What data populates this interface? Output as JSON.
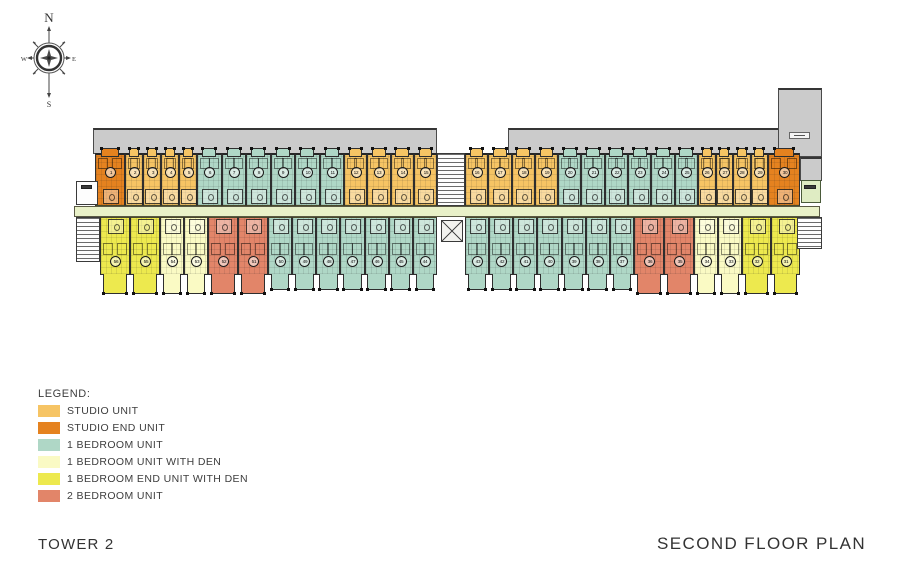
{
  "titles": {
    "tower": "TOWER 2",
    "plan": "SECOND FLOOR PLAN"
  },
  "compass": {
    "north": "N",
    "east": "E",
    "south": "S",
    "west": "W"
  },
  "legend": {
    "title": "LEGEND:",
    "items": [
      {
        "label": "STUDIO UNIT",
        "type": "studio"
      },
      {
        "label": "STUDIO END UNIT",
        "type": "studioEnd"
      },
      {
        "label": "1 BEDROOM UNIT",
        "type": "oneBed"
      },
      {
        "label": "1 BEDROOM UNIT WITH DEN",
        "type": "oneBedDen"
      },
      {
        "label": "1 BEDROOM END UNIT WITH DEN",
        "type": "oneBedEndDen"
      },
      {
        "label": "2 BEDROOM UNIT",
        "type": "twoBed"
      }
    ]
  },
  "colors": {
    "studio": "#F6C464",
    "studioEnd": "#E5821F",
    "oneBed": "#AFD7C6",
    "oneBedDen": "#FAFAC4",
    "oneBedEndDen": "#EDE94E",
    "twoBed": "#E28569",
    "corridor": "#E9F1C8",
    "roof": "#CBCBCB"
  },
  "plan": {
    "roof_areas": [
      {
        "name": "roof-band-left",
        "x": 93,
        "y": 128,
        "w": 344,
        "h": 26
      },
      {
        "name": "roof-band-right",
        "x": 508,
        "y": 128,
        "w": 272,
        "h": 26
      },
      {
        "name": "roof-column-right",
        "x": 778,
        "y": 88,
        "w": 44,
        "h": 69
      },
      {
        "name": "roof-stub-right",
        "x": 800,
        "y": 157,
        "w": 22,
        "h": 24
      }
    ],
    "corridor": {
      "name": "central-corridor",
      "x": 74,
      "y": 206,
      "w": 746,
      "h": 11
    },
    "cores": [
      {
        "kind": "room",
        "name": "left-entry-room",
        "x": 76,
        "y": 181,
        "w": 22,
        "h": 24
      },
      {
        "kind": "chip-dark",
        "name": "left-room-label",
        "x": 81,
        "y": 185,
        "w": 11,
        "h": 4
      },
      {
        "kind": "stair",
        "name": "left-stair",
        "x": 76,
        "y": 217,
        "w": 24,
        "h": 45
      },
      {
        "kind": "stair",
        "name": "center-stair",
        "x": 437,
        "y": 153,
        "w": 28,
        "h": 53
      },
      {
        "kind": "elev",
        "name": "center-elevator",
        "x": 441,
        "y": 220,
        "w": 22,
        "h": 22
      },
      {
        "kind": "room-green",
        "name": "right-utility-room",
        "x": 801,
        "y": 180,
        "w": 20,
        "h": 23
      },
      {
        "kind": "chip-dark",
        "name": "right-room-label",
        "x": 804,
        "y": 185,
        "w": 12,
        "h": 4
      },
      {
        "kind": "stair",
        "name": "right-stair",
        "x": 797,
        "y": 217,
        "w": 25,
        "h": 32
      },
      {
        "kind": "chip-light",
        "name": "roof-column-label",
        "x": 789,
        "y": 132,
        "w": 21,
        "h": 7
      }
    ],
    "top_row": {
      "y": 153,
      "h": 53,
      "segments": [
        {
          "type": "studioEnd",
          "x": 95,
          "w": 30,
          "units": [
            1
          ]
        },
        {
          "type": "studio",
          "x": 125,
          "w": 72,
          "units": [
            2,
            3,
            4,
            5
          ]
        },
        {
          "type": "oneBed",
          "x": 197,
          "w": 147,
          "units": [
            6,
            7,
            8,
            9,
            10,
            11
          ]
        },
        {
          "type": "studio",
          "x": 344,
          "w": 93,
          "units": [
            12,
            13,
            14,
            15
          ]
        },
        {
          "type": "studio",
          "x": 465,
          "w": 93,
          "units": [
            16,
            17,
            18,
            19
          ]
        },
        {
          "type": "oneBed",
          "x": 558,
          "w": 140,
          "units": [
            20,
            21,
            22,
            23,
            24,
            25
          ]
        },
        {
          "type": "studio",
          "x": 698,
          "w": 70,
          "units": [
            26,
            27,
            28,
            29
          ]
        },
        {
          "type": "studioEnd",
          "x": 768,
          "w": 32,
          "units": [
            30
          ]
        }
      ]
    },
    "bottom_row": {
      "y": 217,
      "h": 58,
      "segments": [
        {
          "type": "oneBedEndDen",
          "x": 100,
          "w": 60,
          "units": [
            56,
            55
          ]
        },
        {
          "type": "oneBedDen",
          "x": 160,
          "w": 48,
          "units": [
            54,
            53
          ]
        },
        {
          "type": "twoBed",
          "x": 208,
          "w": 60,
          "units": [
            52,
            51
          ]
        },
        {
          "type": "oneBed",
          "x": 268,
          "w": 169,
          "units": [
            50,
            49,
            48,
            47,
            46,
            45,
            44
          ]
        },
        {
          "type": "oneBed",
          "x": 465,
          "w": 169,
          "units": [
            43,
            42,
            41,
            40,
            39,
            38,
            37
          ]
        },
        {
          "type": "twoBed",
          "x": 634,
          "w": 60,
          "units": [
            36,
            35
          ]
        },
        {
          "type": "oneBedDen",
          "x": 694,
          "w": 48,
          "units": [
            34,
            33
          ]
        },
        {
          "type": "oneBedEndDen",
          "x": 742,
          "w": 58,
          "units": [
            32,
            31
          ]
        }
      ]
    }
  }
}
